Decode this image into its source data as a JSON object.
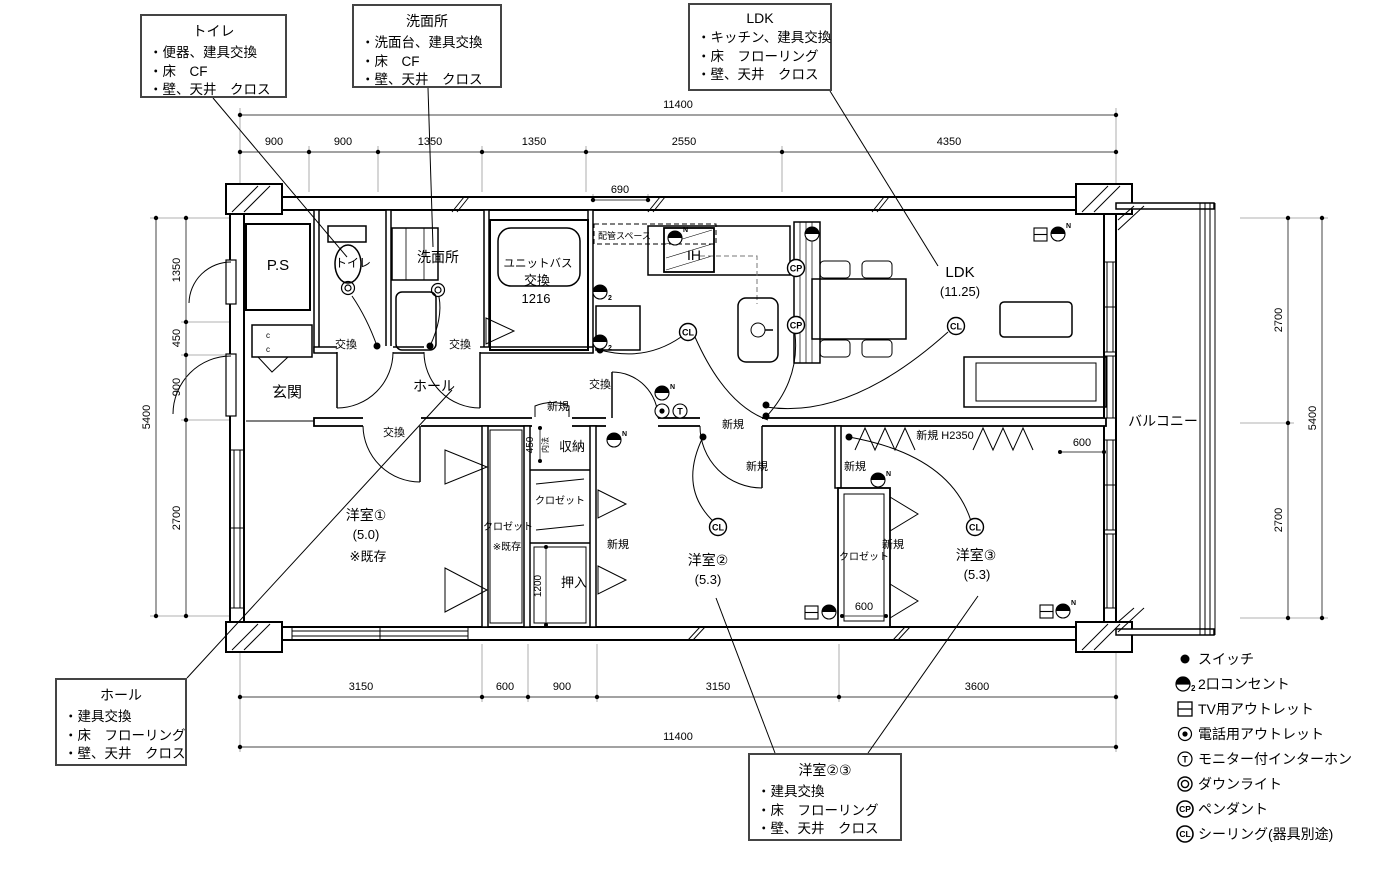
{
  "callouts": {
    "toilet": {
      "title": "トイレ",
      "lines": [
        "・便器、建具交換",
        "・床　CF",
        "・壁、天井　クロス"
      ]
    },
    "washroom": {
      "title": "洗面所",
      "lines": [
        "・洗面台、建具交換",
        "・床　CF",
        "・壁、天井　クロス"
      ]
    },
    "ldk": {
      "title": "LDK",
      "lines": [
        "・キッチン、建具交換",
        "・床　フローリング",
        "・壁、天井　クロス"
      ]
    },
    "hall": {
      "title": "ホール",
      "lines": [
        "・建具交換",
        "・床　フローリング",
        "・壁、天井　クロス"
      ]
    },
    "rooms23": {
      "title": "洋室②③",
      "lines": [
        "・建具交換",
        "・床　フローリング",
        "・壁、天井　クロス"
      ]
    }
  },
  "rooms": {
    "ps": "P.S",
    "genkan": "玄関",
    "toilet": "トイレ",
    "washroom": "洗面所",
    "ub1": "ユニットバス",
    "ub_size": "1216",
    "pipe": "配管スペース",
    "ih": "IH",
    "ldk": "LDK",
    "ldk_size": "(11.25)",
    "hall": "ホール",
    "balcony": "バルコニー",
    "r1": "洋室①",
    "r1_size": "(5.0)",
    "r1_note": "※既存",
    "closet": "クロゼット",
    "closet_note": "※既存",
    "shuno": "収納",
    "oshiire": "押入",
    "r2": "洋室②",
    "r2_size": "(5.3)",
    "r3": "洋室③",
    "r3_size": "(5.3)"
  },
  "labels": {
    "kokan": "交換",
    "shinki": "新規",
    "shinki_h": "新規  H2350",
    "naiho": "内法",
    "c": "c"
  },
  "dims": {
    "top_total": "11400",
    "top": [
      "900",
      "900",
      "1350",
      "1350",
      "2550",
      "4350"
    ],
    "top_sub": "690",
    "left": [
      "1350",
      "450",
      "900",
      "2700"
    ],
    "left_total": "5400",
    "right": [
      "2700",
      "2700"
    ],
    "right_total": "5400",
    "bottom": [
      "3150",
      "600",
      "900",
      "3150",
      "3600"
    ],
    "bottom_total": "11400",
    "n450": "450",
    "n1200": "1200",
    "n600a": "600",
    "n600b": "600"
  },
  "symbols": {
    "cl": "CL",
    "cp": "CP",
    "t": "T",
    "n": "N",
    "two": "2"
  },
  "legend": {
    "items": [
      {
        "icon": "switch-icon",
        "label": "スイッチ"
      },
      {
        "icon": "outlet2-icon",
        "label": "2口コンセント"
      },
      {
        "icon": "tv-outlet-icon",
        "label": "TV用アウトレット"
      },
      {
        "icon": "phone-outlet-icon",
        "label": "電話用アウトレット"
      },
      {
        "icon": "interphone-icon",
        "label": "モニター付インターホン"
      },
      {
        "icon": "downlight-icon",
        "label": "ダウンライト"
      },
      {
        "icon": "pendant-icon",
        "label": "ペンダント"
      },
      {
        "icon": "ceiling-icon",
        "label": "シーリング(器具別途)"
      }
    ]
  }
}
